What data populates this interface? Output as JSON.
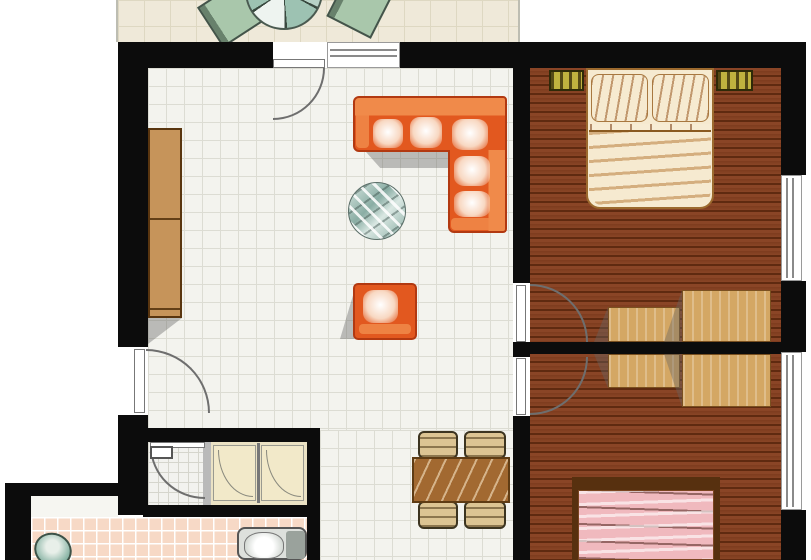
{
  "title": "apartment-floor-plan",
  "colors": {
    "wall": "#0c0c0c",
    "living_floor": "#f3f3ee",
    "living_grid": "#dcdcd3",
    "balcony_floor": "#efe9d9",
    "balcony_grid": "#ded8c2",
    "wood_base": "#8a4526",
    "wood_mid": "#7e3c1e",
    "wood_dark": "#5f2a10",
    "sofa_base": "#e2581f",
    "sofa_back": "#f08a4a",
    "sofa_cushion": "#f8d8c2",
    "sofa_outline": "#b23911",
    "glass_light": "#d9e7e2",
    "glass_dark": "#8aada4",
    "cabinet": "#c6945a",
    "cabinet_dark": "#59350f",
    "desk": "#d4a764",
    "desk_edge": "#7a5020",
    "nightstand": "#c0b23f",
    "bed1": "#f6ead0",
    "bed_frame": "#9c6a2e",
    "headboard2": "#57300f",
    "bed2": "#f0b9be",
    "dining_table": "#a26931",
    "chair_tan": "#dcc493",
    "pink_floor": "#f7d9c6",
    "wc_floor": "#f2f2ef",
    "shower_floor": "#ebe2c4",
    "tray": "#f2e9c9",
    "teal_fixture": "#7fae9e",
    "chair_green": "#a9c7ab",
    "table_green": "#9dc2b2",
    "door_line": "#6e6e6e",
    "shadow": "rgba(100,100,100,0.4)"
  },
  "rooms": [
    {
      "id": "balcony",
      "name": "terrace / balcony",
      "furniture": [
        "garden chair",
        "round garden table",
        "garden chair"
      ]
    },
    {
      "id": "living-room",
      "name": "living / dining room",
      "furniture": [
        "wall cabinet",
        "orange corner sofa",
        "round glass coffee table",
        "orange armchair",
        "dining table",
        "4 dining chairs"
      ]
    },
    {
      "id": "bedroom-1",
      "name": "bedroom top-right",
      "furniture": [
        "double bed cream",
        "nightstand left",
        "nightstand right",
        "small table",
        "large table"
      ]
    },
    {
      "id": "bedroom-2",
      "name": "bedroom bottom-right",
      "furniture": [
        "double bed pink",
        "small table",
        "large table"
      ]
    },
    {
      "id": "wc",
      "name": "wc room",
      "furniture": [
        "cistern"
      ]
    },
    {
      "id": "shower-room",
      "name": "shower room",
      "furniture": [
        "shower tray left",
        "shower tray right"
      ]
    },
    {
      "id": "bathroom",
      "name": "bathroom",
      "furniture": [
        "toilet teal",
        "washbasin unit"
      ]
    }
  ],
  "openings": {
    "doors": [
      "balcony door",
      "entry door",
      "bedroom-1 door",
      "bedroom-2 door",
      "wc door"
    ],
    "windows": [
      "top wall window",
      "right wall window upper",
      "right wall window lower"
    ]
  }
}
